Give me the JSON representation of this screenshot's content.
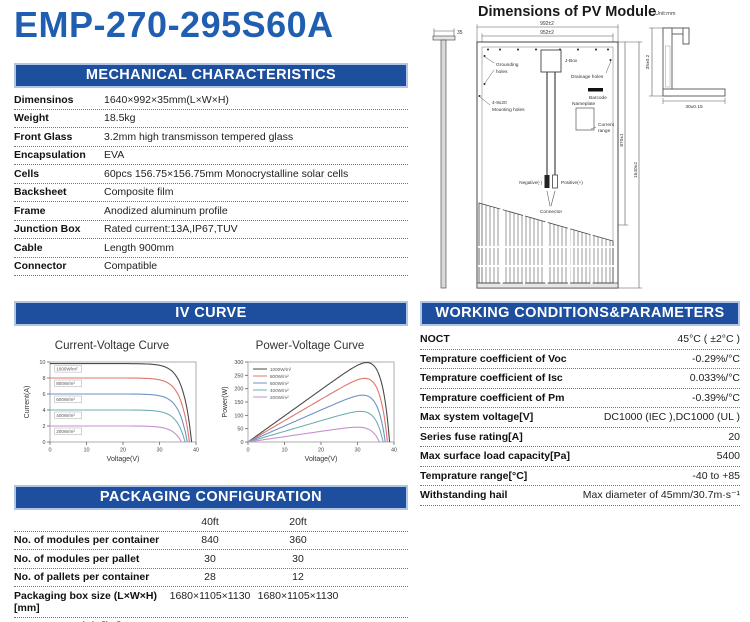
{
  "page": {
    "title": "EMP-270-295S60A"
  },
  "colors": {
    "accent_blue": "#1d4f9e",
    "title_blue": "#1f5eb0",
    "header_border": "#b0c6e4"
  },
  "mechanical": {
    "header": "MECHANICAL CHARACTERISTICS",
    "rows": [
      {
        "label": "Dimensinos",
        "value": "1640×992×35mm(L×W×H)"
      },
      {
        "label": "Weight",
        "value": "18.5kg"
      },
      {
        "label": "Front Glass",
        "value": "3.2mm high transmisson tempered glass"
      },
      {
        "label": "Encapsulation",
        "value": "EVA"
      },
      {
        "label": "Cells",
        "value": "60pcs 156.75×156.75mm Monocrystalline solar cells"
      },
      {
        "label": "Backsheet",
        "value": "Composite film"
      },
      {
        "label": "Frame",
        "value": "Anodized aluminum profile"
      },
      {
        "label": "Junction Box",
        "value": "Rated current:13A,IP67,TUV"
      },
      {
        "label": "Cable",
        "value": "Length 900mm"
      },
      {
        "label": "Connector",
        "value": "Compatible"
      }
    ]
  },
  "iv_section": {
    "header": "IV CURVE"
  },
  "working": {
    "header": "WORKING CONDITIONS&PARAMETERS",
    "rows": [
      {
        "label": "NOCT",
        "value": "45°C ( ±2°C )"
      },
      {
        "label": "Temprature coefficient of Voc",
        "value": "-0.29%/°C"
      },
      {
        "label": "Temprature coefficient of Isc",
        "value": "0.033%/°C"
      },
      {
        "label": "Temprature coefficient of Pm",
        "value": "-0.39%/°C"
      },
      {
        "label": "Max system voltage[V]",
        "value": "DC1000 (IEC ),DC1000 (UL )"
      },
      {
        "label": "Series fuse rating[A]",
        "value": "20"
      },
      {
        "label": "Max surface load capacity[Pa]",
        "value": "5400"
      },
      {
        "label": "Temprature range[°C]",
        "value": "-40 to +85"
      },
      {
        "label": "Withstanding hail",
        "value": "Max diameter of 45mm/30.7m·s⁻¹"
      }
    ]
  },
  "packaging": {
    "header": "PACKAGING CONFIGURATION",
    "columns": [
      "40ft",
      "20ft"
    ],
    "rows": [
      {
        "label": "No. of modules per container",
        "values": [
          "840",
          "360"
        ]
      },
      {
        "label": "No. of modules per pallet",
        "values": [
          "30",
          "30"
        ]
      },
      {
        "label": "No. of pallets per container",
        "values": [
          "28",
          "12"
        ]
      },
      {
        "label": "Packaging box size (L×W×H)[mm]",
        "values": [
          "1680×1105×1130",
          "1680×1105×1130"
        ]
      },
      {
        "label": "Box gross weight[kg]",
        "values": [
          "590",
          "590"
        ]
      }
    ]
  },
  "diagram": {
    "title": "Dimensions of PV Module",
    "unit": "Unit:mm",
    "dim_width_outer": "992±2",
    "dim_width_inner": "952±2",
    "dim_thickness": "35",
    "dim_hole_height": "870±1",
    "dim_height": "1640±2",
    "dim_frame_height": "35±0.2",
    "dim_frame_width": "30±0.15",
    "label_grounding_1": "Grounding",
    "label_grounding_2": "holes",
    "label_jbox": "J-Box",
    "label_drainage": "Drainage holes",
    "label_barcode": "Barcode",
    "label_mounting_1": "4-9x20",
    "label_mounting_2": "Mounting holes",
    "label_nameplate": "Nameplate",
    "label_current_1": "Current",
    "label_current_2": "range",
    "label_negative": "Negative(-)",
    "label_positive": "Positive(+)",
    "label_connector": "Connector"
  },
  "chart_data": [
    {
      "type": "line",
      "curve": "current",
      "title": "Current-Voltage Curve",
      "xlabel": "Voltage(V)",
      "ylabel": "Current(A)",
      "xlim": [
        0,
        40
      ],
      "ylim": [
        0,
        10
      ],
      "xticks": [
        0,
        10,
        20,
        30,
        40
      ],
      "yticks": [
        0,
        2,
        4,
        6,
        8,
        10
      ],
      "grid": false,
      "legend": "inline",
      "series": [
        {
          "name": "1000W/m²",
          "color": "#4a4a4a",
          "isc": 9.8,
          "voc": 38.8
        },
        {
          "name": "800W/m²",
          "color": "#e0756b",
          "isc": 8.0,
          "voc": 38.2
        },
        {
          "name": "600W/m²",
          "color": "#6f92c6",
          "isc": 6.0,
          "voc": 37.6
        },
        {
          "name": "400W/m²",
          "color": "#6fb0b2",
          "isc": 4.0,
          "voc": 37.0
        },
        {
          "name": "200W/m²",
          "color": "#c78fd0",
          "isc": 2.0,
          "voc": 36.0
        }
      ]
    },
    {
      "type": "line",
      "curve": "power",
      "title": "Power-Voltage Curve",
      "xlabel": "Voltage(V)",
      "ylabel": "Power(W)",
      "xlim": [
        0,
        40
      ],
      "ylim": [
        0,
        300
      ],
      "xticks": [
        0,
        10,
        20,
        30,
        40
      ],
      "yticks": [
        0,
        50,
        100,
        150,
        200,
        250,
        300
      ],
      "grid": false,
      "legend": "top-left",
      "series": [
        {
          "name": "1000W/m²",
          "color": "#4a4a4a",
          "isc": 9.8,
          "voc": 38.8,
          "pmax": 295
        },
        {
          "name": "800W/m²",
          "color": "#e0756b",
          "isc": 8.0,
          "voc": 38.2,
          "pmax": 240
        },
        {
          "name": "600W/m²",
          "color": "#6f92c6",
          "isc": 6.0,
          "voc": 37.6,
          "pmax": 180
        },
        {
          "name": "400W/m²",
          "color": "#6fb0b2",
          "isc": 4.0,
          "voc": 37.0,
          "pmax": 118
        },
        {
          "name": "200W/m²",
          "color": "#c78fd0",
          "isc": 2.0,
          "voc": 36.0,
          "pmax": 57
        }
      ]
    }
  ]
}
